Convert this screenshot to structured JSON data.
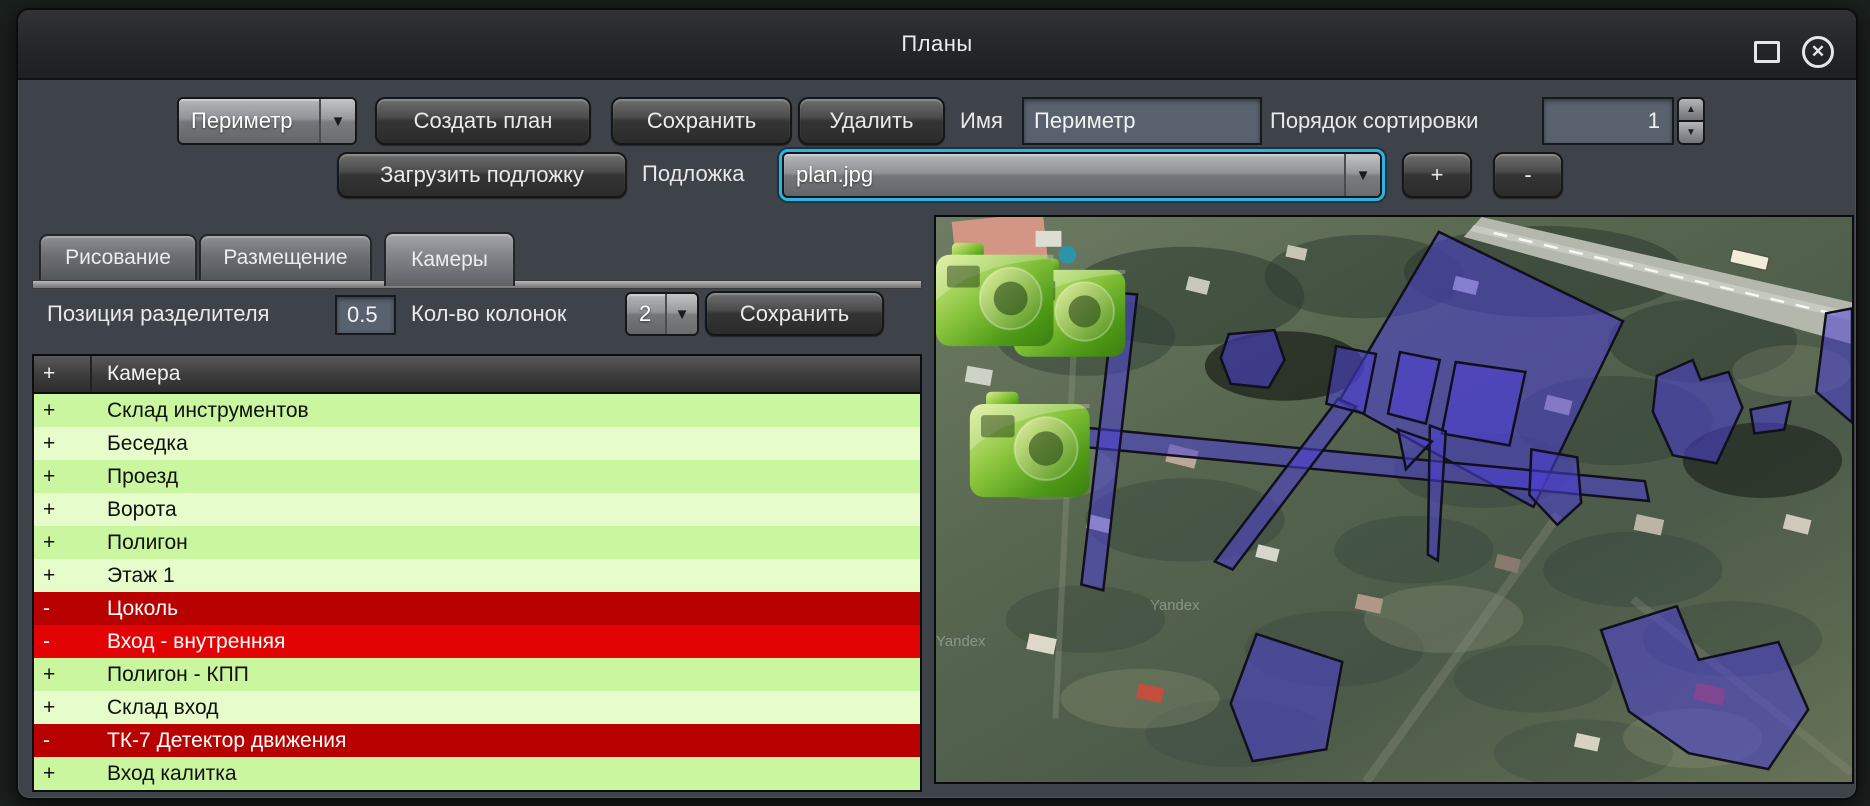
{
  "window": {
    "title": "Планы"
  },
  "toolbar": {
    "plan_dropdown_value": "Периметр",
    "create_plan": "Создать план",
    "save": "Сохранить",
    "delete": "Удалить",
    "name_label": "Имя",
    "name_value": "Периметр",
    "sort_label": "Порядок сортировки",
    "sort_value": "1",
    "load_underlay": "Загрузить подложку",
    "underlay_label": "Подложка",
    "underlay_value": "plan.jpg",
    "add": "+",
    "remove": "-"
  },
  "tabs": [
    {
      "label": "Рисование",
      "active": false
    },
    {
      "label": "Размещение",
      "active": false
    },
    {
      "label": "Камеры",
      "active": true
    }
  ],
  "camera_panel": {
    "splitter_label": "Позиция разделителя",
    "splitter_value": "0.5",
    "columns_label": "Кол-во колонок",
    "columns_value": "2",
    "save": "Сохранить",
    "table": {
      "columns": [
        "+",
        "Камера"
      ],
      "rows": [
        {
          "mark": "+",
          "name": "Склад инструментов",
          "shade": "green_dark"
        },
        {
          "mark": "+",
          "name": "Беседка",
          "shade": "green_light"
        },
        {
          "mark": "+",
          "name": "Проезд",
          "shade": "green_dark"
        },
        {
          "mark": "+",
          "name": "Ворота",
          "shade": "green_light"
        },
        {
          "mark": "+",
          "name": "Полигон",
          "shade": "green_dark"
        },
        {
          "mark": "+",
          "name": "Этаж 1",
          "shade": "green_light"
        },
        {
          "mark": "-",
          "name": "Цоколь",
          "shade": "red_dark"
        },
        {
          "mark": "-",
          "name": "Вход - внутренняя",
          "shade": "red_bright"
        },
        {
          "mark": "+",
          "name": "Полигон - КПП",
          "shade": "green_dark"
        },
        {
          "mark": "+",
          "name": "Склад вход",
          "shade": "green_light"
        },
        {
          "mark": "-",
          "name": "ТК-7 Детектор движения",
          "shade": "red_dark"
        },
        {
          "mark": "+",
          "name": "Вход калитка",
          "shade": "green_dark"
        }
      ]
    }
  },
  "map": {
    "watermark": "Yandex",
    "overlay_fill": "rgba(77,63,214,0.55)",
    "overlay_stroke": "#10101c",
    "polygons": [
      {
        "name": "building-main",
        "points": "505,15 690,105 600,292 405,185"
      },
      {
        "name": "strip-long",
        "points": "148,212 712,266 716,286 152,232"
      },
      {
        "name": "strip-cross",
        "points": "404,183 422,191 298,355 280,347"
      },
      {
        "name": "strip-vertical",
        "points": "180,76 202,78 168,376 146,370"
      },
      {
        "name": "area-left",
        "points": "294,118 340,114 350,144 334,172 296,168 286,142"
      },
      {
        "name": "area-small-1",
        "points": "402,130 442,138 430,198 392,188"
      },
      {
        "name": "area-small-2",
        "points": "466,136 506,144 492,208 454,198"
      },
      {
        "name": "area-small-3",
        "points": "522,146 592,156 576,230 508,218"
      },
      {
        "name": "area-sliver",
        "points": "496,210 512,216 504,346 494,340"
      },
      {
        "name": "area-flag",
        "points": "464,214 498,226 472,254"
      },
      {
        "name": "area-pentagon",
        "points": "598,234 644,242 648,288 624,310 596,280"
      },
      {
        "name": "building-right",
        "points": "724,160 760,144 768,164 796,156 810,192 784,248 740,240 720,196"
      },
      {
        "name": "building-right-tail",
        "points": "818,194 858,186 852,214 822,218"
      },
      {
        "name": "building-edge",
        "points": "894,97 920,92 920,207 884,176"
      },
      {
        "name": "building-bottom-left",
        "points": "322,420 408,448 392,536 318,548 296,490"
      },
      {
        "name": "building-bottom-right",
        "points": "668,416 744,392 766,446 846,428 876,496 836,556 756,540 696,498"
      }
    ],
    "cameras": [
      {
        "x": 78,
        "y": 40,
        "s": 0.95
      },
      {
        "x": 0,
        "y": 24,
        "s": 1.0
      },
      {
        "x": 34,
        "y": 174,
        "s": 1.02
      }
    ],
    "watermarks": [
      {
        "x": 215,
        "y": 396
      },
      {
        "x": 0,
        "y": 432
      }
    ]
  },
  "colors": {
    "green_dark": "#c9f69e",
    "green_light": "#e6fcca",
    "red_dark": "#b80202",
    "red_bright": "#e20404",
    "focus_ring": "#29b5e8"
  }
}
